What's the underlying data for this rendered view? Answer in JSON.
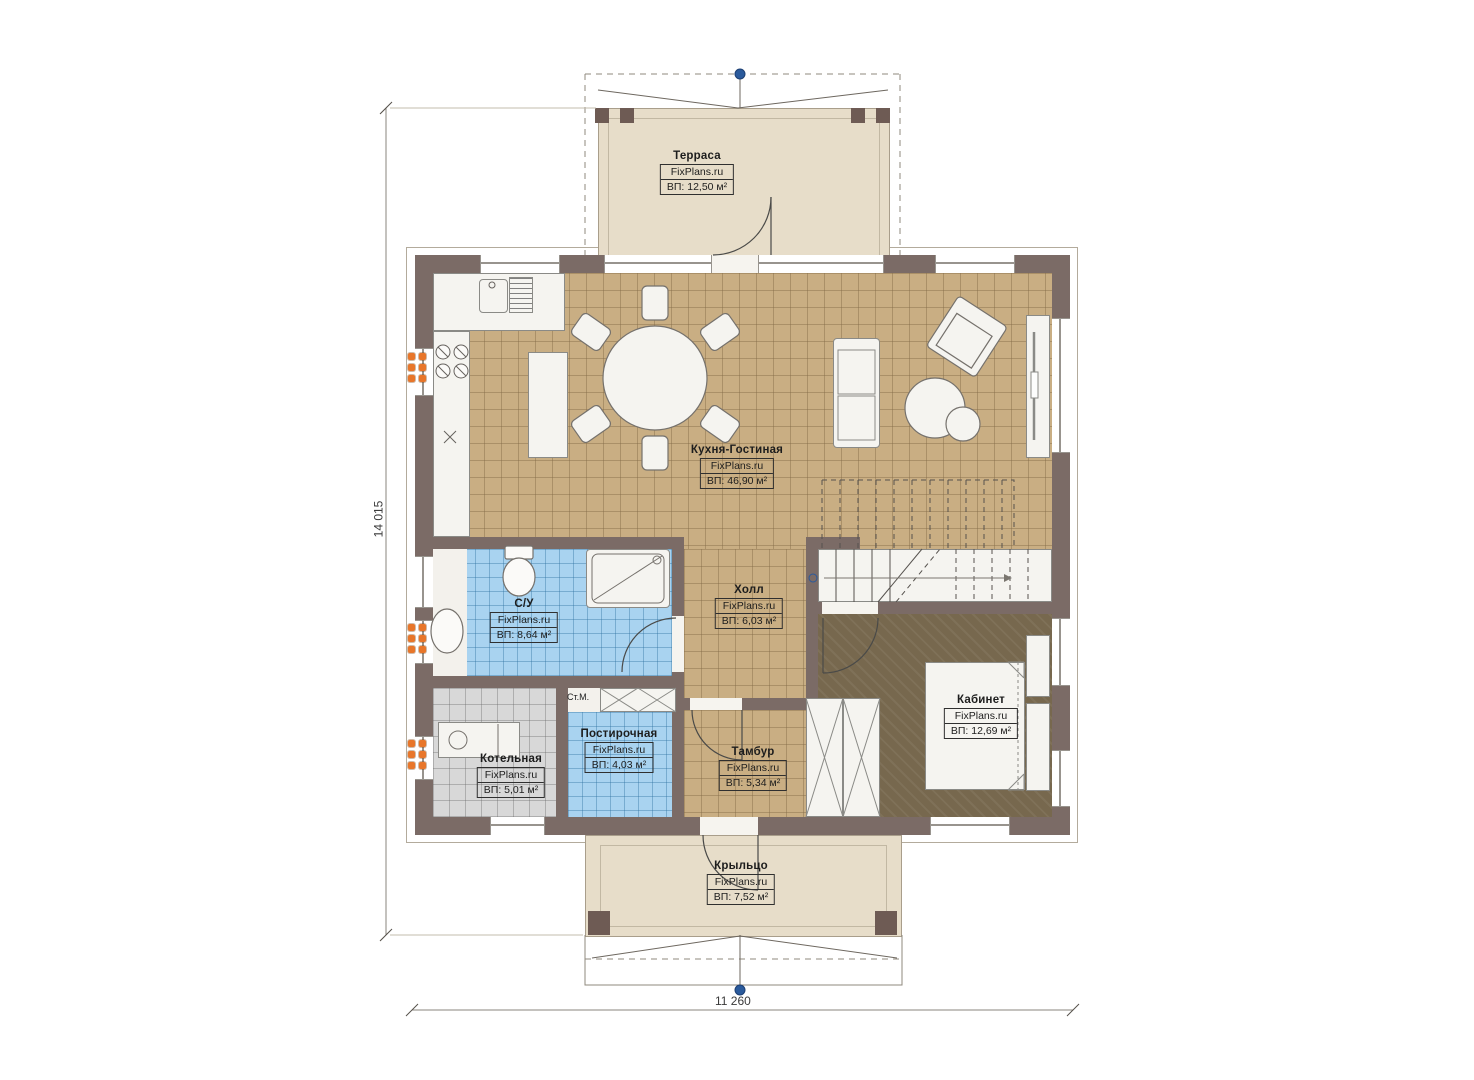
{
  "plan": {
    "brand": "FixPlans.ru",
    "dimensions": {
      "height": "14 015",
      "width": "11 260"
    },
    "rooms": [
      {
        "name": "Терраса",
        "area": "ВП: 12,50 м²"
      },
      {
        "name": "Кухня-Гостиная",
        "area": "ВП: 46,90 м²"
      },
      {
        "name": "С/У",
        "area": "ВП: 8,64 м²"
      },
      {
        "name": "Холл",
        "area": "ВП: 6,03 м²"
      },
      {
        "name": "Котельная",
        "area": "ВП: 5,01 м²"
      },
      {
        "name": "Постирочная",
        "area": "ВП: 4,03 м²"
      },
      {
        "name": "Тамбур",
        "area": "ВП: 5,34 м²"
      },
      {
        "name": "Кабинет",
        "area": "ВП: 12,69 м²"
      },
      {
        "name": "Крыльцо",
        "area": "ВП: 7,52 м²"
      }
    ],
    "annotations": {
      "washing_machine": "Ст.М."
    },
    "colors": {
      "wall": "#7b6b66",
      "tile_tan": "#c9ae83",
      "tile_blue": "#a9d3f0",
      "tile_gray": "#d8d8d8",
      "office_floor": "#77684e",
      "terrace_floor": "#e7ddc9",
      "radiator": "#e8762a",
      "axis_marker": "#2a5a9c"
    }
  }
}
